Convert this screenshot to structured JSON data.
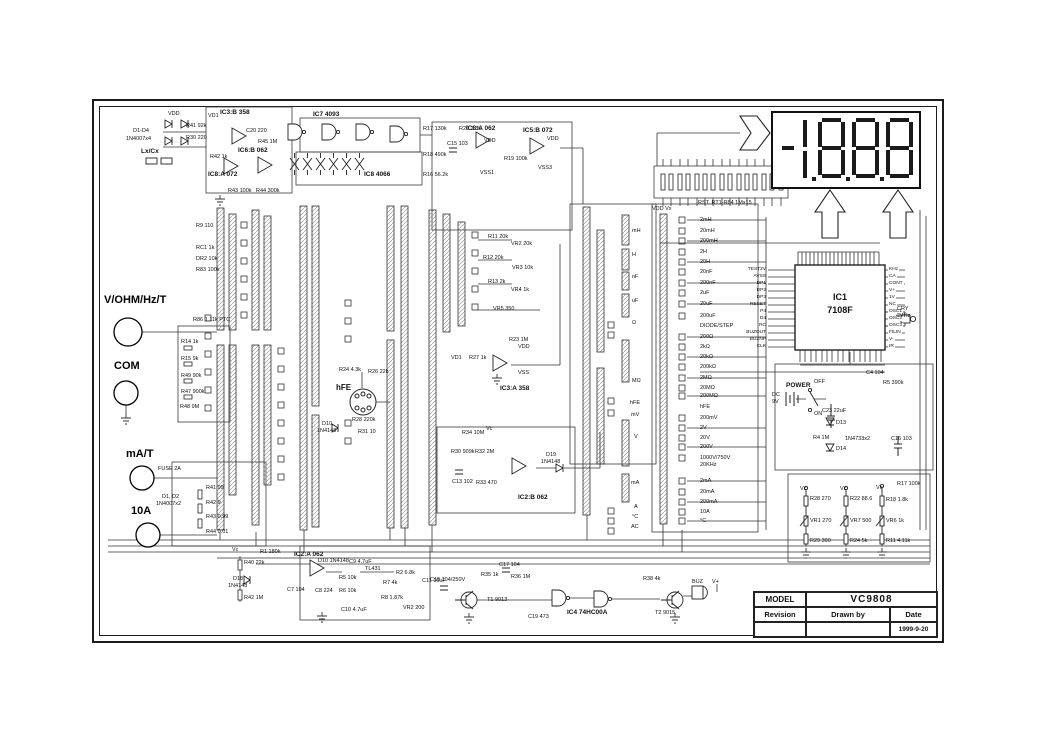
{
  "title_block": {
    "model_label": "MODEL",
    "model": "VC9808",
    "revision": "Revision",
    "drawn_by": "Drawn by",
    "date_label": "Date",
    "date": "1999-9-20"
  },
  "display": {
    "reading": "-1888"
  },
  "terminals": {
    "vohm": "V/OHM/Hz/T",
    "com": "COM",
    "ma": "mA/T",
    "a10": "10A"
  },
  "ic1": {
    "name": "IC1",
    "part": "7108F",
    "pins_left": [
      "TEST2V",
      "AVSS",
      "DP1",
      "DP2",
      "DP3",
      "RESET",
      "P4",
      "D4",
      "RC",
      "BUZOUT",
      "BUZNP",
      "CLK"
    ],
    "pins_right": [
      "KHz",
      "CA",
      "CONT",
      "V+",
      "1V",
      "NC",
      "OSC1",
      "OSC2",
      "OSC3",
      "FILIN",
      "V-",
      "IR"
    ],
    "crystal_1": "CRY",
    "crystal_2": "4MHz",
    "array_label": "RST. RT1-R84  1Mx15",
    "array_power": "VDD  Vx"
  },
  "ranges": [
    "2mH",
    "20mH",
    "200mH",
    "2H",
    "20H",
    "20nF",
    "200nF",
    "2uF",
    "20uF",
    "200uF",
    "DIODE/STEP",
    "200Ω",
    "2kΩ",
    "20kΩ",
    "200kΩ",
    "2MΩ",
    "20MΩ",
    "200MΩ",
    "hFE",
    "200mV",
    "2V",
    "20V",
    "200V",
    "1000V/750V",
    "20KHz",
    "2mA",
    "20mA",
    "200mA",
    "10A",
    "°C"
  ],
  "mode_labels": [
    "mH",
    "H",
    "nF",
    "uF",
    "Ω",
    "MΩ",
    "hFE",
    "mV",
    "V",
    "mA",
    "A",
    "°C",
    "AC"
  ],
  "components": {
    "d1_4a": "D1-D4",
    "d1_4b": "1N4007x4",
    "lxcx": "Lx/Cx",
    "vdd_a": "VDD",
    "vd1_a": "VD1",
    "r41": "R41 92k",
    "r30": "R30 220",
    "r42": "R42 1k",
    "c20": "C20 220",
    "r45": "R45 1M",
    "r43": "R43 100k",
    "r44": "R44 300k",
    "ic3b": "IC3:B 358",
    "ic7": "IC7 4093",
    "ic6b": "IC6:B 062",
    "ic8a": "IC8:A 072",
    "ic84066": "IC8 4066",
    "r17": "R17 130k",
    "r20": "R20 3.3k",
    "c15": "C15 103",
    "r18": "R18 490k",
    "r16": "R16 56.2k",
    "r19": "R19 100k",
    "ic8a062": "IC8:A 062",
    "ic5b": "IC5:B 072",
    "vdd_b": "VDD",
    "vdd_c": "VDD",
    "vss1": "VSS1",
    "vss3": "VSS3",
    "r9": "R9 110",
    "rc1": "RC1 1k",
    "dr2": "DR2 10k",
    "r83": "R83 100k",
    "r86": "R86 1.11k PTC",
    "r14": "R14 1k",
    "r15": "R15 9k",
    "r49": "R49 90k",
    "r47": "R47 900k",
    "r48": "R48 9M",
    "fuse": "FUSE 2A",
    "d12a": "D1, D2",
    "d12b": "1N4007x2",
    "r41s": "R41 99",
    "r42s": "R42 9",
    "r43s": "R43 0.99",
    "r44s": "R44 0.01",
    "r11": "R11 20k",
    "vr2": "VR2 20k",
    "r12": "R12 20k",
    "vr3": "VR3 10k",
    "r13": "R13 2k",
    "vr4": "VR4 1k",
    "vr5": "VR5 350",
    "r23": "R23 1M",
    "r27": "R27 1k",
    "vd1_b": "VD1",
    "vdd_d": "VDD",
    "vss_a": "VSS",
    "ic3a": "IC3:A 358",
    "r34": "R34 10M",
    "vc_a": "Vc",
    "r30b": "R30 909k",
    "r32": "R32 2M",
    "c13": "C13 102",
    "r33": "R33 470",
    "d19a": "D19",
    "d19b": "1N4148",
    "ic2b": "IC2:B 062",
    "hfe": "hFE",
    "r24": "R24 4.3k",
    "r26": "R26 22k",
    "d10a": "D10",
    "d10b2": "1N4148",
    "r28": "R28 220k",
    "r31": "R31 10",
    "vdd_vx": "VDD  Vx",
    "rst": "RST. RT1-R84  1Mx15",
    "cry1": "CRY",
    "cry2": "4MHz",
    "power": "POWER",
    "off": "OFF",
    "on": "ON",
    "dc9v1": "DC",
    "dc9v2": "9V",
    "c23": "C23 22uF",
    "r4": "R4 1M",
    "c4": "C4 104",
    "r5b": "R5 390k",
    "d13": "D13",
    "zd": "1N4733x2",
    "d14": "D14",
    "c16": "C16 103",
    "vc_b": "Vc",
    "r28c": "R28 270",
    "vr1": "VR1 270",
    "r29": "R29 390",
    "vc_c": "Vc",
    "r22": "R22 88.6",
    "vr7": "VR7 500",
    "r24b": "R24 5k",
    "vc_d": "Vc",
    "r18b": "R18 1.8k",
    "vr6": "VR6 1k",
    "r11b": "R11 4.11k",
    "r17b": "R17 100k",
    "vc_e": "Vc",
    "r40": "R40 22k",
    "d18a": "D18",
    "d18b": "1N4148",
    "r42b": "R42 1M",
    "r1": "R1 180k",
    "ic2a": "IC2:A 062",
    "d10c": "D10 1N4148",
    "c9": "C9 4.7uF",
    "tl431": "TL431",
    "r2": "R2 6.8k",
    "c11": "C11 10uF",
    "r5": "R5 10k",
    "r6": "R6 10k",
    "c7": "C7 104",
    "c8": "C8 224",
    "c10": "C10 4.7uF",
    "r7": "R7 4k",
    "r8": "R8 1.87k",
    "vr2b": "VR2 200",
    "c18": "C18 104/250V",
    "r35": "R35 1k",
    "c17": "C17 104",
    "r36": "R36 1M",
    "t1": "T1 9013",
    "c19": "C19 473",
    "ic4": "IC4 74HC00A",
    "r38": "R38 4k",
    "t2": "T2 9015",
    "buz": "BUZ",
    "vplus": "V+"
  }
}
